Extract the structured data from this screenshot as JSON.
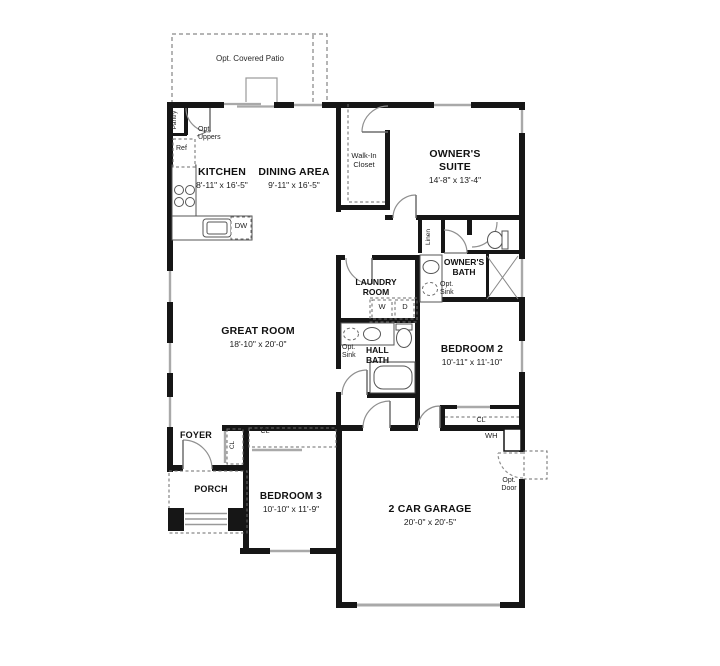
{
  "plan": {
    "patio_label": "Opt. Covered Patio",
    "rooms": {
      "kitchen": {
        "name": "KITCHEN",
        "dims": "8'-11\" x 16'-5\""
      },
      "dining": {
        "name": "DINING AREA",
        "dims": "9'-11\" x 16'-5\""
      },
      "owners_suite": {
        "name": "OWNER'S\nSUITE",
        "dims": "14'-8\" x 13'-4\""
      },
      "walkin_closet": {
        "name": "Walk-In\nCloset"
      },
      "great_room": {
        "name": "GREAT ROOM",
        "dims": "18'-10\" x 20'-0\""
      },
      "laundry": {
        "name": "LAUNDRY\nROOM"
      },
      "owners_bath": {
        "name": "OWNER'S\nBATH"
      },
      "hall_bath": {
        "name": "HALL\nBATH"
      },
      "bedroom2": {
        "name": "BEDROOM 2",
        "dims": "10'-11\" x 11'-10\""
      },
      "bedroom3": {
        "name": "BEDROOM 3",
        "dims": "10'-10\" x 11'-9\""
      },
      "garage": {
        "name": "2 CAR GARAGE",
        "dims": "20'-0\" x 20'-5\""
      },
      "foyer": {
        "name": "FOYER"
      },
      "porch": {
        "name": "PORCH"
      }
    },
    "annotations": {
      "pantry": "Pantry",
      "opt_uppers": "Opt.\nUppers",
      "ref": "Ref",
      "dw": "DW",
      "linen": "Linen",
      "opt_sink_owners": "Opt.\nSink",
      "opt_sink_hall": "Opt.\nSink",
      "washer": "W",
      "dryer": "D",
      "closet_foyer": "CL",
      "closet_bedroom3": "CL",
      "closet_bedroom2": "CL",
      "water_heater": "WH",
      "opt_door": "Opt.\nDoor"
    },
    "colors": {
      "wall": "#161616",
      "window": "#a9a9a9",
      "door_arc": "#8f8f8f",
      "dashed": "#6b6b6b",
      "fixture": "#555555"
    }
  }
}
